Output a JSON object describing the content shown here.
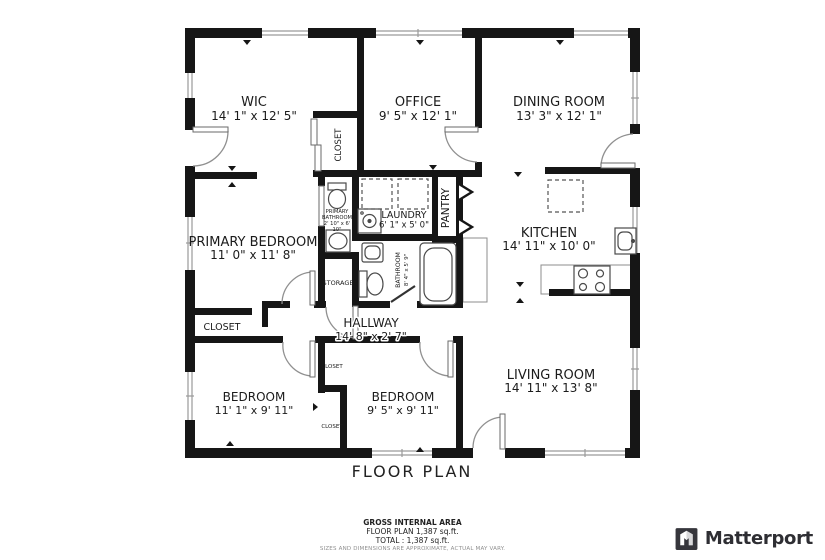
{
  "title": "FLOOR PLAN",
  "footer": {
    "line1": "GROSS INTERNAL AREA",
    "line2": "FLOOR PLAN 1,387 sq.ft.",
    "line3": "TOTAL :  1,387 sq.ft.",
    "disclaimer": "SIZES AND DIMENSIONS ARE APPROXIMATE, ACTUAL MAY VARY."
  },
  "brand": {
    "name": "Matterport"
  },
  "colors": {
    "wall": "#161616",
    "fixture": "#4a4a4a",
    "door_arc": "#909090",
    "window_line": "#9a9a9a",
    "counter": "#8c8c8c",
    "text": "#1b1b1b",
    "muted": "#8f8f8f",
    "brand_dark": "#36363c"
  },
  "rooms": [
    {
      "id": "wic",
      "lines": [
        "WIC",
        "14' 1\" x 12' 5\""
      ],
      "x": 254,
      "y": 106,
      "s": [
        13,
        12
      ],
      "lh": 14
    },
    {
      "id": "office",
      "lines": [
        "OFFICE",
        "9' 5\" x 12' 1\""
      ],
      "x": 418,
      "y": 106,
      "s": [
        13,
        12
      ],
      "lh": 14
    },
    {
      "id": "dining-room",
      "lines": [
        "DINING ROOM",
        "13' 3\" x 12' 1\""
      ],
      "x": 559,
      "y": 106,
      "s": [
        13,
        12
      ],
      "lh": 14
    },
    {
      "id": "primary-bedroom",
      "lines": [
        "PRIMARY BEDROOM",
        "11' 0\" x 11' 8\""
      ],
      "x": 253,
      "y": 246,
      "s": [
        13,
        12
      ],
      "lh": 13
    },
    {
      "id": "kitchen",
      "lines": [
        "KITCHEN",
        "14' 11\" x 10' 0\""
      ],
      "x": 549,
      "y": 237,
      "s": [
        13,
        12
      ],
      "lh": 13
    },
    {
      "id": "living-room",
      "lines": [
        "LIVING ROOM",
        "14' 11\" x 13' 8\""
      ],
      "x": 551,
      "y": 379,
      "s": [
        13,
        12
      ],
      "lh": 13
    },
    {
      "id": "bedroom-left",
      "lines": [
        "BEDROOM",
        "11' 1\" x 9' 11\""
      ],
      "x": 254,
      "y": 401,
      "s": [
        12,
        11
      ],
      "lh": 13
    },
    {
      "id": "bedroom-right",
      "lines": [
        "BEDROOM",
        "9' 5\" x 9' 11\""
      ],
      "x": 403,
      "y": 401,
      "s": [
        12,
        11
      ],
      "lh": 13
    },
    {
      "id": "hallway",
      "lines": [
        "HALLWAY",
        "14' 8\" x 2' 7\""
      ],
      "x": 371,
      "y": 327,
      "s": [
        12,
        11
      ],
      "lh": 13,
      "halo": true
    },
    {
      "id": "laundry",
      "lines": [
        "LAUNDRY",
        "6' 1\" x 5' 0\""
      ],
      "x": 404,
      "y": 218,
      "s": [
        9.5,
        8.5
      ],
      "lh": 9.5
    },
    {
      "id": "closet-wic",
      "lines": [
        "CLOSET"
      ],
      "x": 341,
      "y": 145,
      "s": [
        8.5
      ],
      "rot": -90
    },
    {
      "id": "pantry",
      "lines": [
        "PANTRY"
      ],
      "x": 449,
      "y": 208,
      "s": [
        10.5
      ],
      "rot": -90
    },
    {
      "id": "bathroom",
      "lines": [
        "BATHROOM",
        "8' 4\" x 5' 9\""
      ],
      "x": 400,
      "y": 270,
      "s": [
        6.2,
        5.5
      ],
      "lh": 8,
      "rot": -90
    },
    {
      "id": "primary-bathroom",
      "lines": [
        "PRIMARY",
        "BATHROOM",
        "2' 10\" x 6'",
        "10\""
      ],
      "x": 337,
      "y": 213,
      "s": [
        5.2,
        5.2,
        5.2,
        5.2
      ],
      "lh": 6
    },
    {
      "id": "storage",
      "lines": [
        "STORAGE"
      ],
      "x": 338,
      "y": 285,
      "s": [
        6.5
      ]
    },
    {
      "id": "closet-primary",
      "lines": [
        "CLOSET"
      ],
      "x": 222,
      "y": 330,
      "s": [
        9.5
      ]
    },
    {
      "id": "closet-top",
      "lines": [
        "CLOSET"
      ],
      "x": 332,
      "y": 368,
      "s": [
        5.5
      ]
    },
    {
      "id": "closet-bottom",
      "lines": [
        "CLOSET"
      ],
      "x": 332,
      "y": 428,
      "s": [
        5.5
      ]
    }
  ]
}
